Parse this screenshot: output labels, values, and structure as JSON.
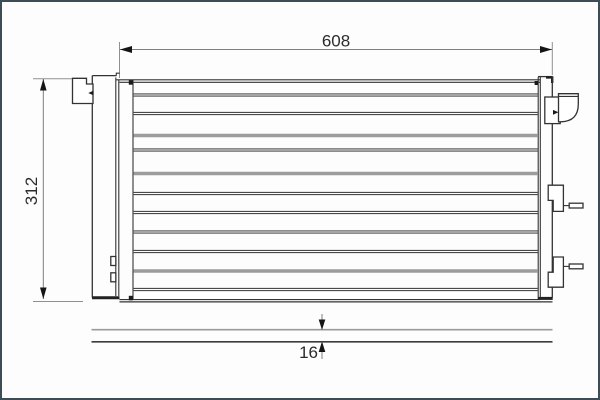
{
  "drawing": {
    "title": "condenser-technical-drawing",
    "dimensions": {
      "width": {
        "label": "608"
      },
      "height": {
        "label": "312"
      },
      "thickness": {
        "label": "16"
      }
    },
    "colors": {
      "frame": "#3e4d55",
      "background": "#fdfdfd",
      "outline": "#333333",
      "dimension_line": "#7f7f7f",
      "arrow": "#151515",
      "fin_gray": "#9c9c9c"
    }
  }
}
